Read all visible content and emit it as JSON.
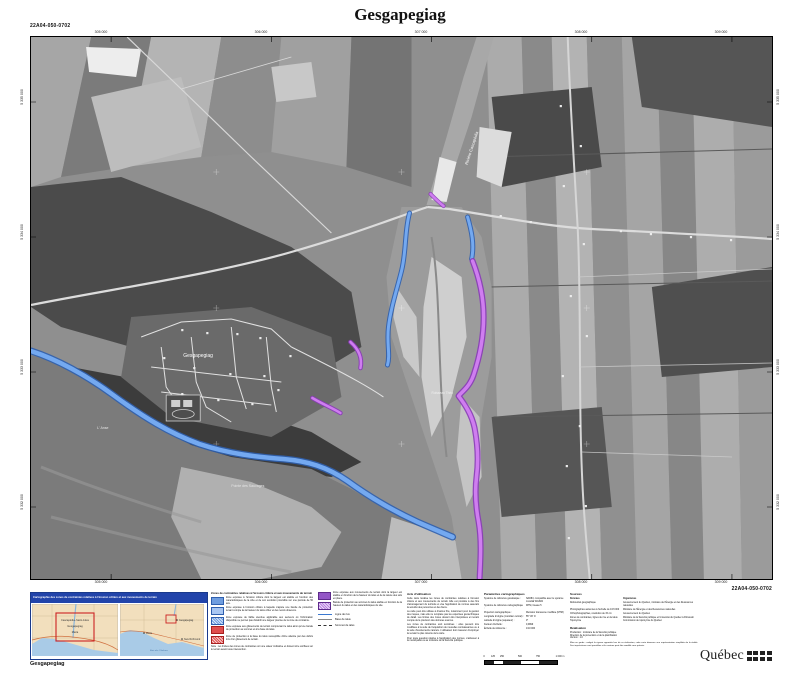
{
  "sheet": {
    "title": "Gesgapegiag",
    "code_top_left": "22A04-050-0702",
    "code_bottom_right": "22A04-050-0702",
    "footer_name": "Gesgapegiag"
  },
  "map": {
    "labels": {
      "village": "Gesgapegiag",
      "point": "Pointe des Sauvages",
      "anse": "L' Anse",
      "stream": "Ruisseau Théo",
      "river": "Rivière Cascapédia"
    },
    "ticks_top": [
      "305 000",
      "306 000",
      "307 000",
      "308 000",
      "309 000"
    ],
    "ticks_bottom": [
      "305 000",
      "306 000",
      "307 000",
      "308 000",
      "309 000"
    ],
    "ticks_left": [
      "5 335 000",
      "5 334 000",
      "5 333 000",
      "5 332 000"
    ],
    "ticks_right": [
      "5 335 000",
      "5 334 000",
      "5 333 000",
      "5 332 000"
    ],
    "colors": {
      "erosion_zone": "#74a9f0",
      "erosion_edge": "#2f5fae",
      "landslide_zone": "#cf7df0",
      "landslide_edge": "#8a3bb8"
    }
  },
  "title_box": {
    "header": "Cartographie des zones de contraintes relatives à l'érosion côtière et aux mouvements de terrain",
    "inset_left": {
      "labels": [
        "Cascapédia–Saint-Jules",
        "Gesgapegiag",
        "Maria"
      ]
    },
    "inset_right": {
      "labels": [
        "Gesgapegiag",
        "Maria",
        "New Richmond"
      ],
      "water_label": "Baie des Chaleurs"
    }
  },
  "legend": {
    "title": "Zones de contraintes relatives à l'érosion côtière et aux mouvements de terrain",
    "items": [
      {
        "text": "Zone exposée à l'érosion côtière dont la largeur est établie en fonction des caractéristiques de la côte et de son évolution prévisible sur une période de 50 ans."
      },
      {
        "text": "Zone exposée à l'érosion côtière à laquelle s'ajoute une bande de protection tenant compte de la hauteur du talus côtier et des reculs observés."
      },
      {
        "text": "Zone exposée de faible étendue applicable aux secteurs où l'information disponible ne permet pas d'établir une largeur précise de la zone de contrainte."
      },
      {
        "text": "Zone exposée aux glissements de terrain comprenant le talus ainsi qu'une bande de protection au sommet et à la base du talus."
      },
      {
        "text": "Zone de protection à la base du talus susceptible d'être atteinte par des débris lors d'un glissement de terrain."
      }
    ],
    "note": "Note : les limites des zones de contraintes ont une valeur indicative et doivent être vérifiées sur le terrain avant toute intervention.",
    "purple_items": [
      {
        "text": "Zone exposée aux mouvements de terrain dont la largeur est établie en fonction de la hauteur du talus et de la nature des sols en place."
      },
      {
        "text": "Bande de protection au sommet du talus établie en fonction de la hauteur du talus et des caractéristiques du site."
      }
    ],
    "lines": [
      "Ligne de rive",
      "Base de talus",
      "Sommet de talus"
    ]
  },
  "avis": {
    "title": "Avis d'utilisation",
    "paragraphs": [
      "Cette carte localise les zones de contraintes relatives à l'érosion côtière et aux mouvements de terrain. Elle est produite à des fins d'aménagement du territoire et vise l'application de normes assurant la sécurité des personnes et des biens.",
      "La carte peut être utilisée à d'autres fins, notamment pour la gestion des risques, mais elle ne remplace pas les expertises géotechniques de détail. Les limites des zones doivent être interprétées en tenant compte de la précision des données sources.",
      "Les zones de contraintes sont évolutives : elles peuvent être modifiées à la suite de l'acquisition de nouvelles connaissances ou à la suite d'événements naturels. L'utilisateur doit s'assurer d'employer la version la plus récente de la carte.",
      "Pour toute question relative à l'application des normes, s'adresser à la municipalité ou au ministère de la Sécurité publique."
    ]
  },
  "params": {
    "title": "Paramètres cartographiques",
    "rows": [
      [
        "Système de référence géodésique :",
        "NAD83, compatible avec le système mondial WGS84"
      ],
      [
        "Système de référence cartographique :",
        "MTM, fuseau 5"
      ],
      [
        "Projection cartographique :",
        "Mercator transverse modifiée (MTM)"
      ],
      [
        "Longitude d'origine (méridien central) :",
        "55° 30' O"
      ],
      [
        "Latitude d'origine (équateur) :",
        "0°"
      ],
      [
        "Facteur d'échelle :",
        "0,9999"
      ],
      [
        "Échelle de référence :",
        "1/10 000"
      ]
    ]
  },
  "scalebar": {
    "labels": [
      "0",
      "125",
      "250",
      "500",
      "750",
      "1 000 m"
    ]
  },
  "sources": {
    "title": "Sources",
    "col_data": "Données",
    "col_org": "Organismes",
    "rows": [
      [
        "Référentiel géographique",
        "Gouvernement du Québec, ministère de l'Énergie et des Ressources naturelles"
      ],
      [
        "Photographies aériennes à l'échelle de 1/15 000",
        "Ministère de l'Énergie et des Ressources naturelles"
      ],
      [
        "Orthophotographies, résolution de 15 cm",
        "Gouvernement du Québec"
      ],
      [
        "Zones de contraintes, lignes de rive et de talus",
        "Ministère de la Sécurité publique et Université du Québec à Rimouski"
      ],
      [
        "Toponymie",
        "Commission de toponymie du Québec"
      ]
    ]
  },
  "realisation": {
    "title": "Réalisation",
    "lines": [
      "Production : ministère de la Sécurité publique",
      "Direction de la prévention et de la planification",
      "Version : 1.0"
    ],
    "warning": "Mise en garde : malgré la rigueur apportée lors de sa réalisation, cette carte demeure une représentation simplifiée de la réalité. Des imprécisions sont possibles et le contenu peut être modifié sans préavis."
  },
  "logo": {
    "wordmark": "Québec"
  }
}
